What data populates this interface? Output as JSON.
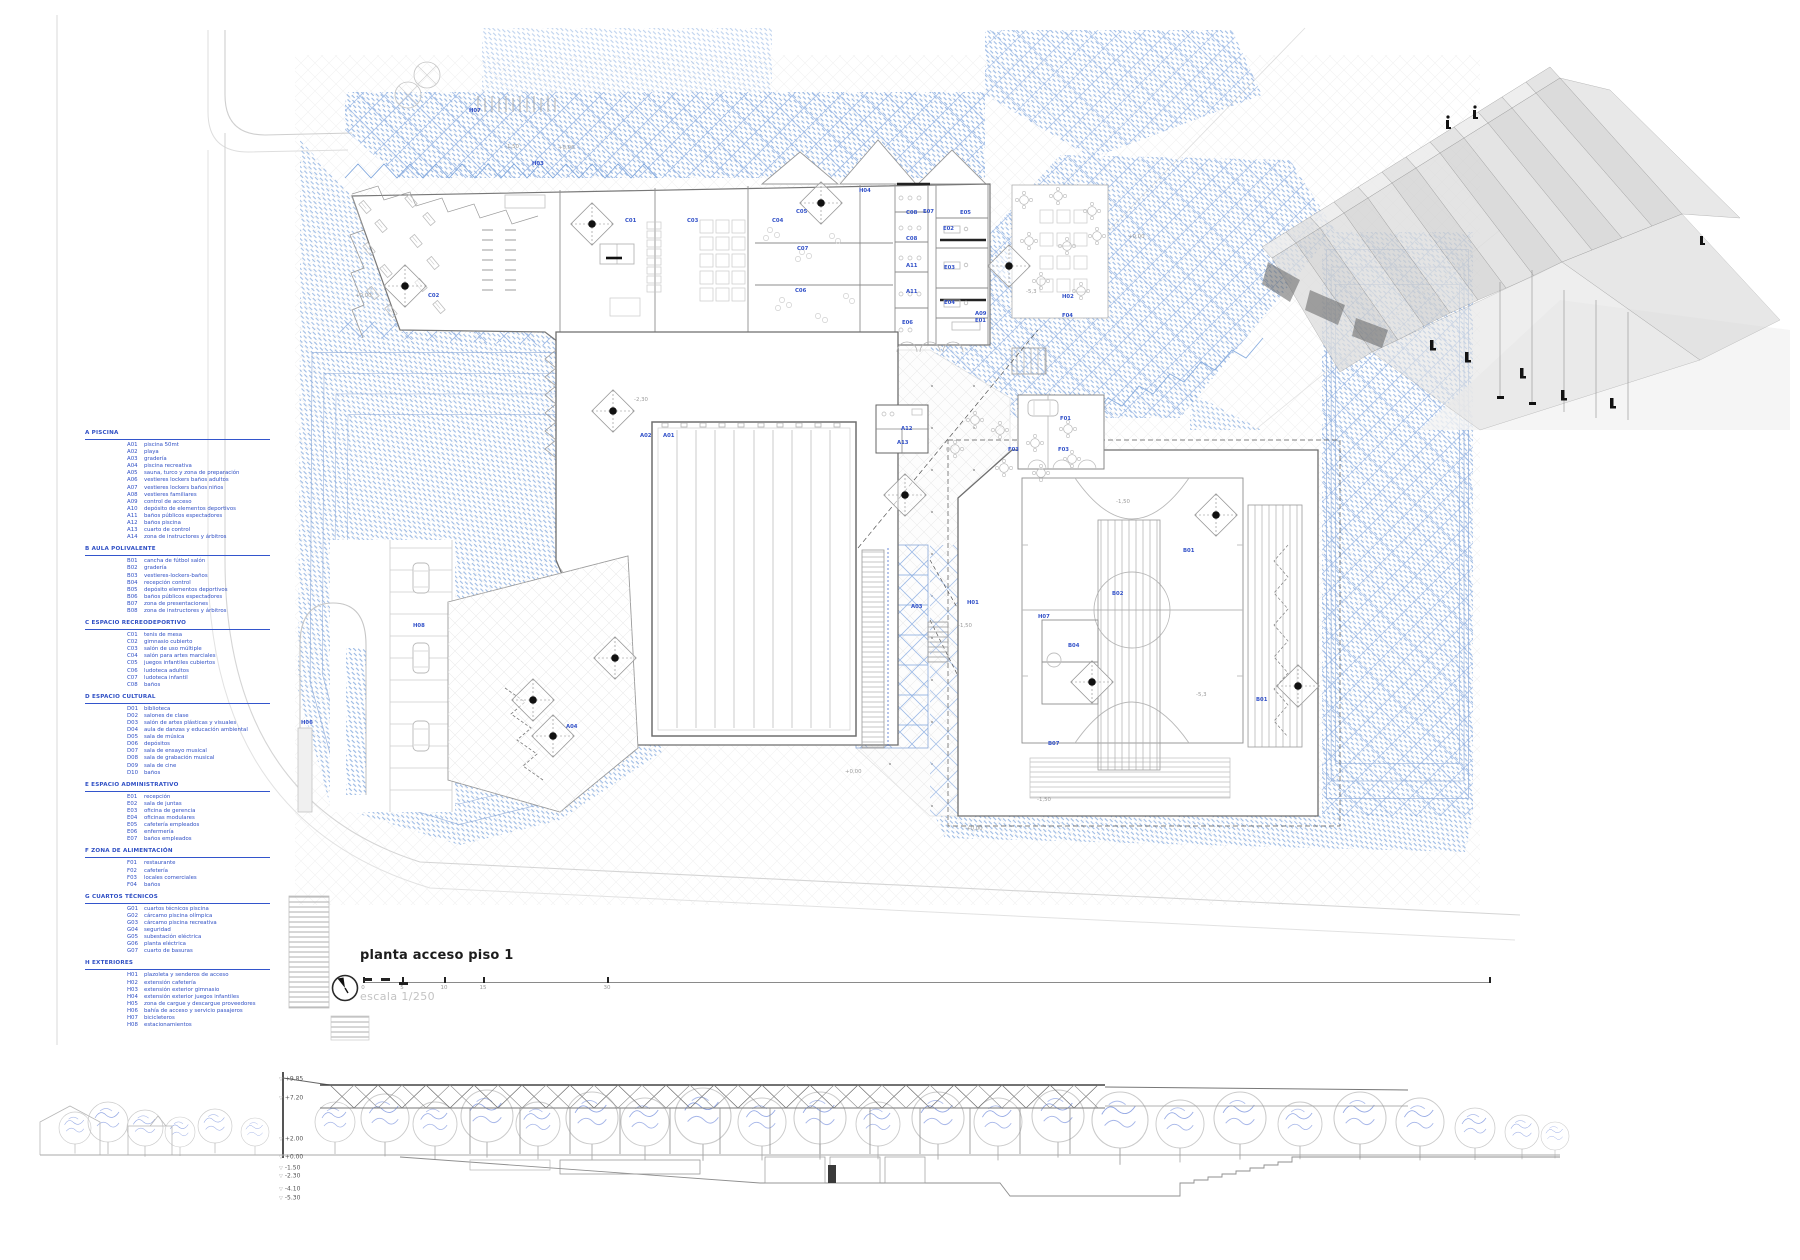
{
  "title_block": {
    "title": "planta acceso piso 1",
    "scale_label": "escala 1/250",
    "scale_ticks": [
      {
        "label": "0",
        "x": 363
      },
      {
        "label": "5",
        "x": 402
      },
      {
        "label": "10",
        "x": 444
      },
      {
        "label": "15",
        "x": 483
      },
      {
        "label": "30",
        "x": 607
      },
      {
        "label": "",
        "x": 1489
      }
    ]
  },
  "colors": {
    "legend_blue": "#2f4fc4",
    "hatch_blue": "#7fa6dc",
    "grid_blue": "#9fbbe6",
    "label_blue": "#3150c8",
    "line_gray": "#999999",
    "level_gray": "#9a9a9a"
  },
  "legend": {
    "sections": [
      {
        "title": "A PISCINA",
        "items": [
          {
            "code": "A01",
            "label": "piscina 50mt"
          },
          {
            "code": "A02",
            "label": "playa"
          },
          {
            "code": "A03",
            "label": "gradería"
          },
          {
            "code": "A04",
            "label": "piscina recreativa"
          },
          {
            "code": "A05",
            "label": "sauna, turco y zona de preparación"
          },
          {
            "code": "A06",
            "label": "vestieres lockers baños adultos"
          },
          {
            "code": "A07",
            "label": "vestieres lockers baños niños"
          },
          {
            "code": "A08",
            "label": "vestieres familiares"
          },
          {
            "code": "A09",
            "label": "control de acceso"
          },
          {
            "code": "A10",
            "label": "depósito de elementos deportivos"
          },
          {
            "code": "A11",
            "label": "baños públicos espectadores"
          },
          {
            "code": "A12",
            "label": "baños piscina"
          },
          {
            "code": "A13",
            "label": "cuarto de control"
          },
          {
            "code": "A14",
            "label": "zona de instructores y árbitros"
          }
        ]
      },
      {
        "title": "B AULA POLIVALENTE",
        "items": [
          {
            "code": "B01",
            "label": "cancha de fútbol salón"
          },
          {
            "code": "B02",
            "label": "gradería"
          },
          {
            "code": "B03",
            "label": "vestieres-lockers-baños"
          },
          {
            "code": "B04",
            "label": "recepción control"
          },
          {
            "code": "B05",
            "label": "depósito elementos deportivos"
          },
          {
            "code": "B06",
            "label": "baños públicos espectadores"
          },
          {
            "code": "B07",
            "label": "zona de presentaciones"
          },
          {
            "code": "B08",
            "label": "zona de instructores y árbitros"
          }
        ]
      },
      {
        "title": "C ESPACIO RECREODEPORTIVO",
        "items": [
          {
            "code": "C01",
            "label": "tenis de mesa"
          },
          {
            "code": "C02",
            "label": "gimnasio cubierto"
          },
          {
            "code": "C03",
            "label": "salón de uso múltiple"
          },
          {
            "code": "C04",
            "label": "salón para artes marciales"
          },
          {
            "code": "C05",
            "label": "juegos infantiles cubiertos"
          },
          {
            "code": "C06",
            "label": "ludoteca adultos"
          },
          {
            "code": "C07",
            "label": "ludoteca infantil"
          },
          {
            "code": "C08",
            "label": "baños"
          }
        ]
      },
      {
        "title": "D ESPACIO CULTURAL",
        "items": [
          {
            "code": "D01",
            "label": "biblioteca"
          },
          {
            "code": "D02",
            "label": "salones de clase"
          },
          {
            "code": "D03",
            "label": "salón de artes plásticas y visuales"
          },
          {
            "code": "D04",
            "label": "aula de danzas y educación ambiental"
          },
          {
            "code": "D05",
            "label": "sala de música"
          },
          {
            "code": "D06",
            "label": "depósitos"
          },
          {
            "code": "D07",
            "label": "sala de ensayo musical"
          },
          {
            "code": "D08",
            "label": "sala de grabación musical"
          },
          {
            "code": "D09",
            "label": "sala de cine"
          },
          {
            "code": "D10",
            "label": "baños"
          }
        ]
      },
      {
        "title": "E ESPACIO ADMINISTRATIVO",
        "items": [
          {
            "code": "E01",
            "label": "recepción"
          },
          {
            "code": "E02",
            "label": "sala de juntas"
          },
          {
            "code": "E03",
            "label": "oficina de gerencia"
          },
          {
            "code": "E04",
            "label": "oficinas modulares"
          },
          {
            "code": "E05",
            "label": "cafetería empleados"
          },
          {
            "code": "E06",
            "label": "enfermería"
          },
          {
            "code": "E07",
            "label": "baños empleados"
          }
        ]
      },
      {
        "title": "F ZONA DE ALIMENTACIÓN",
        "items": [
          {
            "code": "F01",
            "label": "restaurante"
          },
          {
            "code": "F02",
            "label": "cafetería"
          },
          {
            "code": "F03",
            "label": "locales comerciales"
          },
          {
            "code": "F04",
            "label": "baños"
          }
        ]
      },
      {
        "title": "G CUARTOS TÉCNICOS",
        "items": [
          {
            "code": "G01",
            "label": "cuartos técnicos piscina"
          },
          {
            "code": "G02",
            "label": "cárcamo piscina olímpica"
          },
          {
            "code": "G03",
            "label": "cárcamo piscina recreativa"
          },
          {
            "code": "G04",
            "label": "seguridad"
          },
          {
            "code": "G05",
            "label": "subestación eléctrica"
          },
          {
            "code": "G06",
            "label": "planta eléctrica"
          },
          {
            "code": "G07",
            "label": "cuarto de basuras"
          }
        ]
      },
      {
        "title": "H EXTERIORES",
        "items": [
          {
            "code": "H01",
            "label": "plazoleta y senderos de acceso"
          },
          {
            "code": "H02",
            "label": "extensión cafetería"
          },
          {
            "code": "H03",
            "label": "extensión exterior gimnasio"
          },
          {
            "code": "H04",
            "label": "extensión exterior juegos infantiles"
          },
          {
            "code": "H05",
            "label": "zona de cargue y descargue proveedores"
          },
          {
            "code": "H06",
            "label": "bahía de acceso y servicio pasajeros"
          },
          {
            "code": "H07",
            "label": "bicicleteros"
          },
          {
            "code": "H08",
            "label": "estacionamientos"
          }
        ]
      }
    ]
  },
  "plan_labels": [
    {
      "text": "A01",
      "x": 663,
      "y": 436
    },
    {
      "text": "A02",
      "x": 640,
      "y": 436
    },
    {
      "text": "A03",
      "x": 911,
      "y": 607
    },
    {
      "text": "A04",
      "x": 566,
      "y": 727
    },
    {
      "text": "A09",
      "x": 975,
      "y": 314
    },
    {
      "text": "A11",
      "x": 906,
      "y": 266
    },
    {
      "text": "A11",
      "x": 906,
      "y": 292
    },
    {
      "text": "A12",
      "x": 901,
      "y": 429
    },
    {
      "text": "A13",
      "x": 897,
      "y": 443
    },
    {
      "text": "B01",
      "x": 1183,
      "y": 551
    },
    {
      "text": "B01",
      "x": 1256,
      "y": 700
    },
    {
      "text": "B02",
      "x": 1112,
      "y": 594
    },
    {
      "text": "B04",
      "x": 1068,
      "y": 646
    },
    {
      "text": "B07",
      "x": 1048,
      "y": 744
    },
    {
      "text": "C01",
      "x": 625,
      "y": 221
    },
    {
      "text": "C02",
      "x": 428,
      "y": 296
    },
    {
      "text": "C03",
      "x": 687,
      "y": 221
    },
    {
      "text": "C04",
      "x": 772,
      "y": 221
    },
    {
      "text": "C05",
      "x": 796,
      "y": 212
    },
    {
      "text": "C06",
      "x": 795,
      "y": 291
    },
    {
      "text": "C07",
      "x": 797,
      "y": 249
    },
    {
      "text": "C08",
      "x": 906,
      "y": 213
    },
    {
      "text": "C08",
      "x": 906,
      "y": 239
    },
    {
      "text": "E01",
      "x": 975,
      "y": 321
    },
    {
      "text": "E02",
      "x": 943,
      "y": 229
    },
    {
      "text": "E03",
      "x": 944,
      "y": 268
    },
    {
      "text": "E04",
      "x": 944,
      "y": 303
    },
    {
      "text": "E05",
      "x": 960,
      "y": 213
    },
    {
      "text": "E06",
      "x": 902,
      "y": 323
    },
    {
      "text": "E07",
      "x": 923,
      "y": 212
    },
    {
      "text": "F01",
      "x": 1060,
      "y": 419
    },
    {
      "text": "F03",
      "x": 1008,
      "y": 450
    },
    {
      "text": "F03",
      "x": 1058,
      "y": 450
    },
    {
      "text": "F04",
      "x": 1062,
      "y": 316
    },
    {
      "text": "H01",
      "x": 967,
      "y": 603
    },
    {
      "text": "H02",
      "x": 1062,
      "y": 297
    },
    {
      "text": "H03",
      "x": 532,
      "y": 164
    },
    {
      "text": "H04",
      "x": 859,
      "y": 191
    },
    {
      "text": "H06",
      "x": 301,
      "y": 723
    },
    {
      "text": "H07",
      "x": 469,
      "y": 111
    },
    {
      "text": "H07",
      "x": 1038,
      "y": 617
    },
    {
      "text": "H08",
      "x": 413,
      "y": 626
    }
  ],
  "level_marks": [
    {
      "text": "+0,00",
      "x": 355,
      "y": 296
    },
    {
      "text": "+0,00",
      "x": 558,
      "y": 148
    },
    {
      "text": "-1,50",
      "x": 505,
      "y": 147
    },
    {
      "text": "+0,00",
      "x": 1128,
      "y": 237
    },
    {
      "text": "-2,30",
      "x": 634,
      "y": 400
    },
    {
      "text": "-1,50",
      "x": 958,
      "y": 626
    },
    {
      "text": "-1,50",
      "x": 1116,
      "y": 502
    },
    {
      "text": "-5,3",
      "x": 1026,
      "y": 292
    },
    {
      "text": "-5,3",
      "x": 1196,
      "y": 695
    },
    {
      "text": "+0,00",
      "x": 966,
      "y": 829
    },
    {
      "text": "-1,50",
      "x": 1037,
      "y": 800
    },
    {
      "text": "+0,00",
      "x": 845,
      "y": 772
    }
  ],
  "section_view": {
    "levels": [
      {
        "text": "+9.85",
        "x": 293,
        "y": 1079
      },
      {
        "text": "+7.20",
        "x": 293,
        "y": 1098
      },
      {
        "text": "+2.00",
        "x": 293,
        "y": 1139
      },
      {
        "text": "+0.00",
        "x": 293,
        "y": 1157
      },
      {
        "text": "-1.50",
        "x": 293,
        "y": 1168
      },
      {
        "text": "-2.30",
        "x": 293,
        "y": 1176
      },
      {
        "text": "-4.10",
        "x": 293,
        "y": 1189
      },
      {
        "text": "-5.30",
        "x": 293,
        "y": 1198
      }
    ]
  }
}
